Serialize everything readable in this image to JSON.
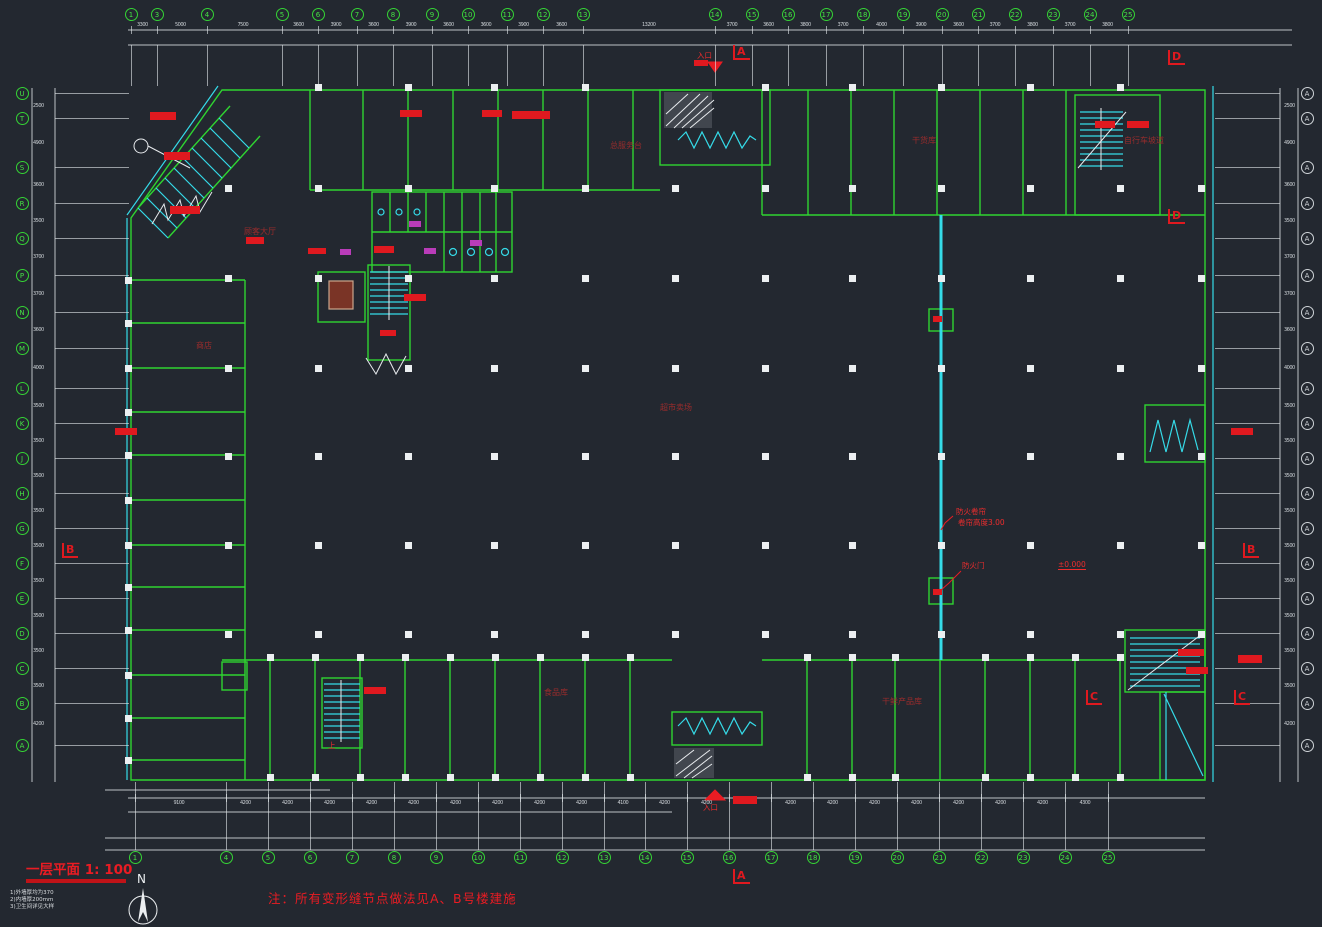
{
  "plan": {
    "title": "一层平面 1: 100",
    "title_notes": [
      "1)外墙厚均为370",
      "2)内墙厚200mm",
      "3)卫生间详见大样"
    ],
    "note": "注：所有变形缝节点做法见A、B号楼建施",
    "north_label": "N",
    "background": "#232830",
    "wall_color": "#2fd431",
    "accent_cyan": "#35dbe8",
    "annotation_red": "#ea1c23"
  },
  "room_labels": [
    {
      "text": "顾客大厅",
      "x": 244,
      "y": 226
    },
    {
      "text": "商店",
      "x": 196,
      "y": 340
    },
    {
      "text": "总服务台",
      "x": 610,
      "y": 140
    },
    {
      "text": "干货库",
      "x": 912,
      "y": 135
    },
    {
      "text": "自行车坡道",
      "x": 1124,
      "y": 135
    },
    {
      "text": "超市卖场",
      "x": 660,
      "y": 402
    },
    {
      "text": "食品库",
      "x": 544,
      "y": 687
    },
    {
      "text": "干鲜产品库",
      "x": 882,
      "y": 696
    }
  ],
  "annotations": [
    {
      "text": "防火卷帘",
      "x": 956,
      "y": 506
    },
    {
      "text": "卷帘高度3.00",
      "x": 958,
      "y": 517
    },
    {
      "text": "防火门",
      "x": 962,
      "y": 560
    },
    {
      "text": "±0.000",
      "x": 1058,
      "y": 560,
      "underline": true
    },
    {
      "text": "入口",
      "x": 703,
      "y": 802
    },
    {
      "text": "入口",
      "x": 697,
      "y": 50
    },
    {
      "text": "上",
      "x": 328,
      "y": 740
    }
  ],
  "section_markers": [
    {
      "label": "A",
      "x": 733,
      "y": 45
    },
    {
      "label": "A",
      "x": 733,
      "y": 869
    },
    {
      "label": "D",
      "x": 1168,
      "y": 50
    },
    {
      "label": "D",
      "x": 1168,
      "y": 209
    },
    {
      "label": "B",
      "x": 62,
      "y": 543
    },
    {
      "label": "B",
      "x": 1243,
      "y": 543
    },
    {
      "label": "C",
      "x": 1086,
      "y": 690
    },
    {
      "label": "C",
      "x": 1234,
      "y": 690
    }
  ],
  "axes": {
    "top": {
      "y": 14,
      "xs": [
        131,
        157,
        207,
        282,
        318,
        357,
        393,
        432,
        468,
        507,
        543,
        583,
        715,
        752,
        788,
        826,
        863,
        903,
        942,
        978,
        1015,
        1053,
        1090,
        1128
      ],
      "labels": [
        "1",
        "3",
        "4",
        "5",
        "6",
        "7",
        "8",
        "9",
        "10",
        "11",
        "12",
        "13",
        "14",
        "15",
        "16",
        "17",
        "18",
        "19",
        "20",
        "21",
        "22",
        "23",
        "24",
        "25"
      ]
    },
    "bottom": {
      "y": 857,
      "xs": [
        135,
        226,
        268,
        310,
        352,
        394,
        436,
        478,
        520,
        562,
        604,
        645,
        687,
        729,
        771,
        813,
        855,
        897,
        939,
        981,
        1023,
        1065,
        1108
      ],
      "labels": [
        "1",
        "4",
        "5",
        "6",
        "7",
        "8",
        "9",
        "10",
        "11",
        "12",
        "13",
        "14",
        "15",
        "16",
        "17",
        "18",
        "19",
        "20",
        "21",
        "22",
        "23",
        "24",
        "25"
      ]
    },
    "left": {
      "x": 22,
      "ys": [
        93,
        118,
        167,
        203,
        238,
        275,
        312,
        348,
        388,
        423,
        458,
        493,
        528,
        563,
        598,
        633,
        668,
        703,
        745
      ],
      "labels": [
        "U",
        "T",
        "S",
        "R",
        "Q",
        "P",
        "N",
        "M",
        "L",
        "K",
        "J",
        "H",
        "G",
        "F",
        "E",
        "D",
        "C",
        "B",
        "A"
      ]
    },
    "right": {
      "x": 1307,
      "ys": [
        93,
        118,
        167,
        203,
        238,
        275,
        312,
        348,
        388,
        423,
        458,
        493,
        528,
        563,
        598,
        633,
        668,
        703,
        745
      ],
      "labels": [
        "A",
        "A",
        "A",
        "A",
        "A",
        "A",
        "A",
        "A",
        "A",
        "A",
        "A",
        "A",
        "A",
        "A",
        "A",
        "A",
        "A",
        "A",
        "A"
      ]
    }
  },
  "dims": {
    "top": {
      "y": 22,
      "values": [
        "3300",
        "5000",
        "7500",
        "3600",
        "3900",
        "3600",
        "3900",
        "3600",
        "3600",
        "3900",
        "3600",
        "13200",
        "3700",
        "3600",
        "3800",
        "3700",
        "4000",
        "3900",
        "3600",
        "3700",
        "3800",
        "3700",
        "3800"
      ]
    },
    "bottom": {
      "y": 800,
      "values": [
        "9100",
        "4200",
        "4200",
        "4200",
        "4200",
        "4200",
        "4200",
        "4200",
        "4200",
        "4200",
        "4100",
        "4200",
        "4200",
        "4200",
        "4200",
        "4200",
        "4200",
        "4200",
        "4200",
        "4200",
        "4200",
        "4300"
      ]
    },
    "left": {
      "x": 33,
      "values": [
        "2500",
        "4900",
        "3600",
        "3500",
        "3700",
        "3700",
        "3600",
        "4000",
        "3500",
        "3500",
        "3500",
        "3500",
        "3500",
        "3500",
        "3500",
        "3500",
        "3500",
        "4200"
      ]
    },
    "right": {
      "x": 1284,
      "values": [
        "2500",
        "4900",
        "3600",
        "3500",
        "3700",
        "3700",
        "3600",
        "4000",
        "3500",
        "3500",
        "3500",
        "3500",
        "3500",
        "3500",
        "3500",
        "3500",
        "3500",
        "4200"
      ]
    }
  },
  "columns": {
    "xs": [
      228,
      318,
      408,
      494,
      585,
      675,
      765,
      852,
      941,
      1030,
      1120
    ],
    "ys": [
      188,
      278,
      368,
      456,
      545,
      634
    ]
  },
  "wall_columns": {
    "top": {
      "y": 87,
      "xs": [
        318,
        408,
        494,
        585,
        765,
        852,
        941,
        1030,
        1120
      ]
    },
    "bottom": {
      "ys": [
        657,
        777
      ],
      "xs": [
        270,
        315,
        360,
        405,
        450,
        495,
        540,
        585,
        630,
        807,
        852,
        895,
        985,
        1030,
        1075,
        1120
      ]
    },
    "left": {
      "x": 128,
      "ys": [
        280,
        323,
        368,
        412,
        455,
        500,
        545,
        587,
        630,
        675,
        718,
        760
      ]
    },
    "right": {
      "x": 1201,
      "ys": [
        188,
        278,
        368,
        456,
        545,
        634
      ]
    }
  },
  "red_blobs": [
    {
      "x": 150,
      "y": 112,
      "w": 26,
      "h": 8
    },
    {
      "x": 164,
      "y": 152,
      "w": 26,
      "h": 8
    },
    {
      "x": 170,
      "y": 206,
      "w": 30,
      "h": 8
    },
    {
      "x": 246,
      "y": 237,
      "w": 18,
      "h": 7
    },
    {
      "x": 400,
      "y": 110,
      "w": 22,
      "h": 7
    },
    {
      "x": 482,
      "y": 110,
      "w": 20,
      "h": 7
    },
    {
      "x": 512,
      "y": 111,
      "w": 38,
      "h": 8
    },
    {
      "x": 374,
      "y": 246,
      "w": 20,
      "h": 7
    },
    {
      "x": 308,
      "y": 248,
      "w": 18,
      "h": 6
    },
    {
      "x": 404,
      "y": 294,
      "w": 22,
      "h": 7
    },
    {
      "x": 380,
      "y": 330,
      "w": 16,
      "h": 6
    },
    {
      "x": 115,
      "y": 428,
      "w": 22,
      "h": 7
    },
    {
      "x": 1231,
      "y": 428,
      "w": 22,
      "h": 7
    },
    {
      "x": 1095,
      "y": 121,
      "w": 20,
      "h": 7
    },
    {
      "x": 1127,
      "y": 121,
      "w": 22,
      "h": 7
    },
    {
      "x": 364,
      "y": 687,
      "w": 22,
      "h": 7
    },
    {
      "x": 1178,
      "y": 649,
      "w": 26,
      "h": 7
    },
    {
      "x": 1186,
      "y": 667,
      "w": 22,
      "h": 7
    },
    {
      "x": 1238,
      "y": 655,
      "w": 24,
      "h": 8
    },
    {
      "x": 733,
      "y": 796,
      "w": 24,
      "h": 8
    },
    {
      "x": 694,
      "y": 60,
      "w": 14,
      "h": 6
    },
    {
      "x": 933,
      "y": 316,
      "w": 9,
      "h": 6
    },
    {
      "x": 933,
      "y": 589,
      "w": 9,
      "h": 6
    }
  ],
  "mag_blobs": [
    {
      "x": 340,
      "y": 249,
      "w": 11,
      "h": 6
    },
    {
      "x": 409,
      "y": 221,
      "w": 12,
      "h": 6
    },
    {
      "x": 424,
      "y": 248,
      "w": 12,
      "h": 6
    },
    {
      "x": 470,
      "y": 240,
      "w": 12,
      "h": 6
    }
  ]
}
